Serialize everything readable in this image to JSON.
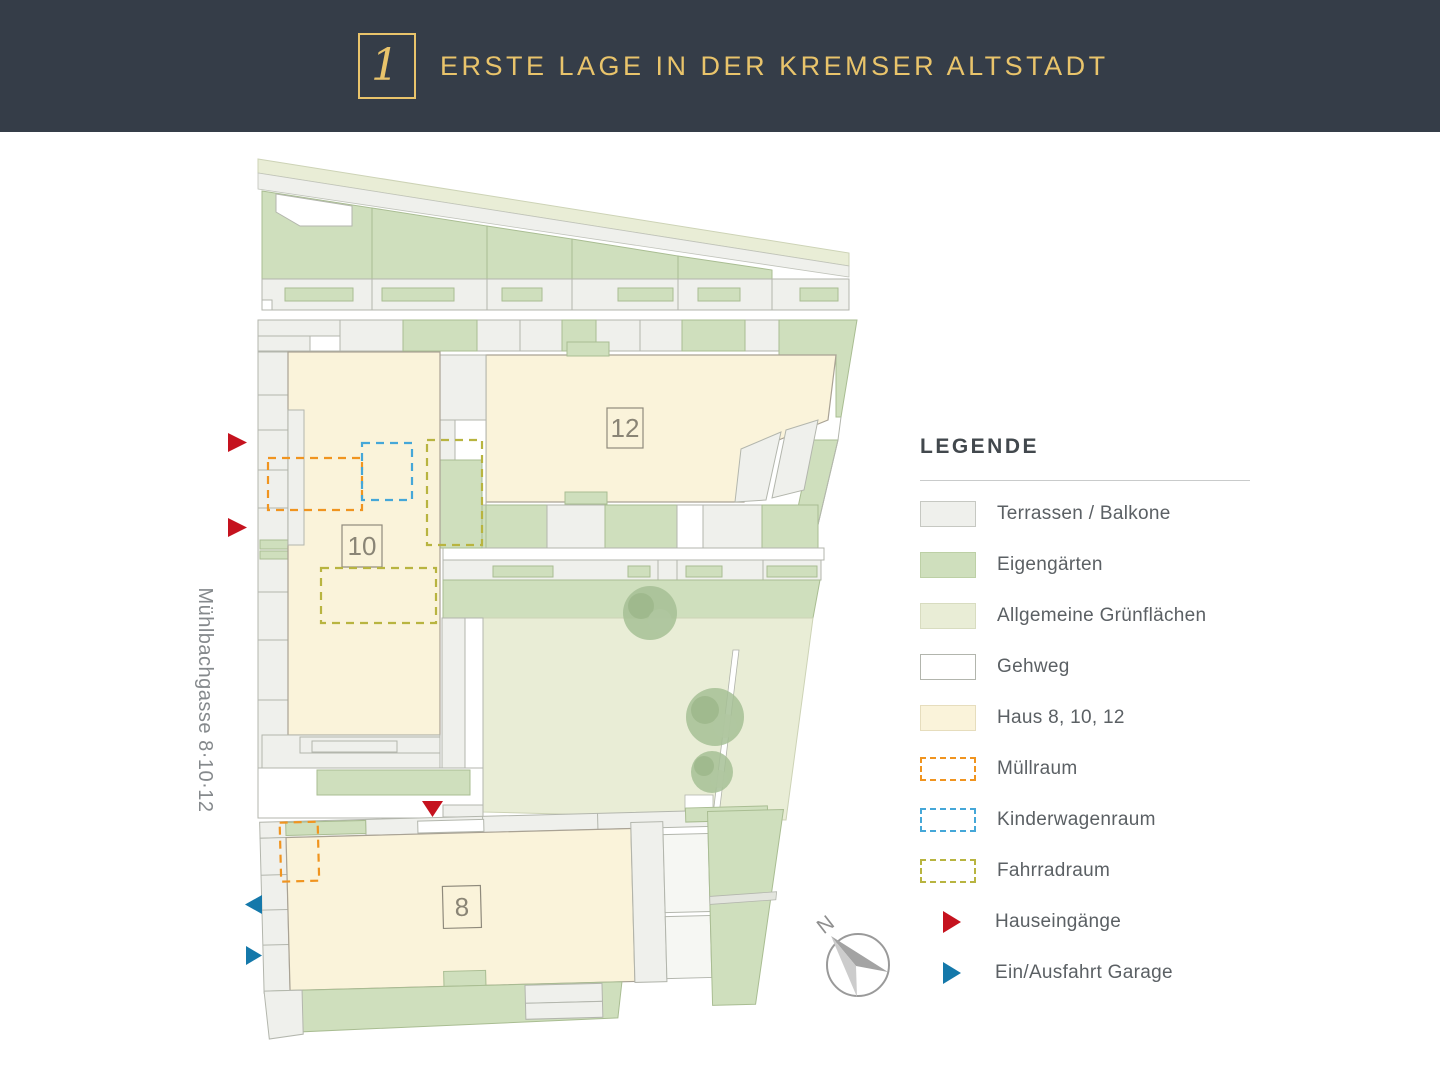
{
  "header": {
    "title": "ERSTE LAGE IN DER KREMSER ALTSTADT",
    "logo_glyph": "1"
  },
  "plan": {
    "street_label": "Mühlbachgasse 8·10·12",
    "buildings": [
      {
        "label": "12"
      },
      {
        "label": "10"
      },
      {
        "label": "8"
      }
    ],
    "compass_label": "N"
  },
  "legend": {
    "title": "LEGENDE",
    "items": [
      {
        "label": "Terrassen / Balkone",
        "kind": "fill",
        "fill": "#eff0ec",
        "border": "#c6c8c2"
      },
      {
        "label": "Eigengärten",
        "kind": "fill",
        "fill": "#cfdfbd",
        "border": "#bdd0a6"
      },
      {
        "label": "Allgemeine Grünflächen",
        "kind": "fill",
        "fill": "#e9edd6",
        "border": "#d8dcc0"
      },
      {
        "label": "Gehweg",
        "kind": "fill",
        "fill": "#ffffff",
        "border": "#b2b5ad"
      },
      {
        "label": "Haus 8, 10, 12",
        "kind": "fill",
        "fill": "#faf3da",
        "border": "#e6ddbd"
      },
      {
        "label": "Müllraum",
        "kind": "dashed",
        "color": "#f0941f"
      },
      {
        "label": "Kinderwagenraum",
        "kind": "dashed",
        "color": "#45a7d8"
      },
      {
        "label": "Fahrradraum",
        "kind": "dashed",
        "color": "#b8b440"
      },
      {
        "label": "Hauseingänge",
        "kind": "arrow",
        "color": "#c5121e"
      },
      {
        "label": "Ein/Ausfahrt Garage",
        "kind": "arrow",
        "color": "#1478aa"
      }
    ]
  },
  "colors": {
    "header_bg": "#353d48",
    "gold": "#e9c46b",
    "terraces": "#eff0ec",
    "private_garden": "#cfdfbd",
    "common_green": "#e9edd6",
    "walkway": "#ffffff",
    "house": "#faf3da",
    "muellraum": "#f0941f",
    "kinderwagen": "#45a7d8",
    "fahrrad": "#b8b440",
    "entrance": "#c5121e",
    "garage": "#1478aa"
  }
}
